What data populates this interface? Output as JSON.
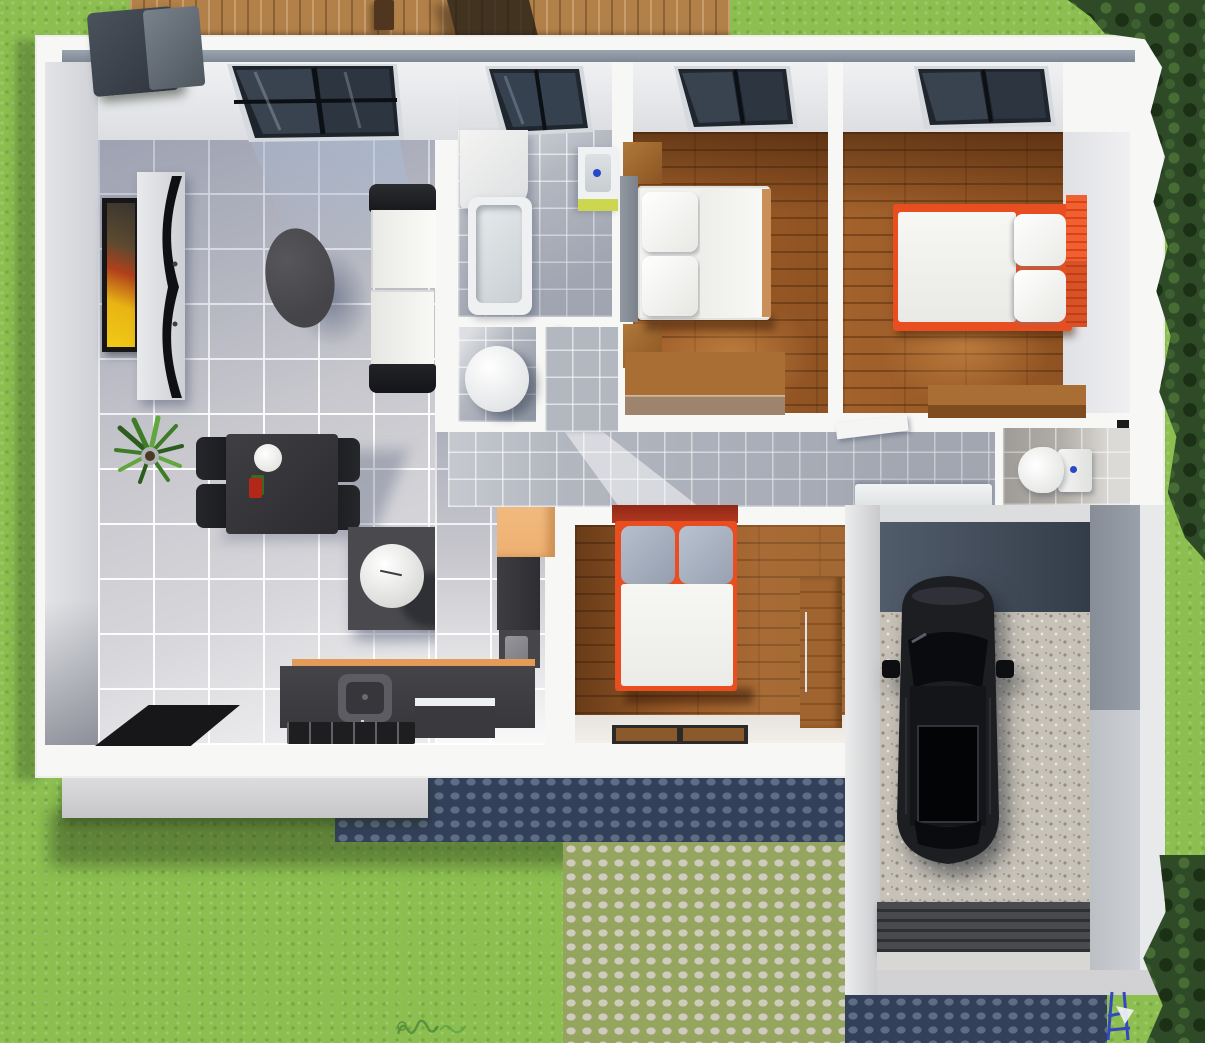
{
  "meta": {
    "content_type": "3d-floor-plan-render",
    "view": "top-down isometric",
    "canvas": {
      "width": 1205,
      "height": 1043
    },
    "text_visible": "none (illegible green watermark bottom-left of path)"
  },
  "palette": {
    "grass": "#8cbf50",
    "grass_dark": "#6fa83a",
    "deck_wood": "#b28049",
    "wall_white": "#f7f7f5",
    "slate_trim": "#8b97a2",
    "living_tile": "#c7c7cd",
    "bath_tile": "#b3b7c0",
    "bedroom_wood": "#9a5c28",
    "accent_orange": "#e84e20",
    "cabinet_peach": "#f5c188",
    "dark_furniture": "#3c3c40",
    "garage_concrete": "#4a5462",
    "garage_gravel": "#c7c2b8",
    "cobble_moss": "#95a45f",
    "cobble_stone": "#d0cbbf",
    "cobble_shadow": "#33405a",
    "trees": "#2e4a26",
    "car_black": "#17181b"
  },
  "outdoor": {
    "lawn": "green grass surrounds house",
    "deck": {
      "position": "top",
      "material": "wood planks",
      "objects": [
        "bbq-grill",
        "wood-post",
        "shade-square"
      ]
    },
    "trees": [
      "dense bushes along right edge top",
      "bush bottom-right corner"
    ],
    "driveway": {
      "material": "cobblestone",
      "areas": [
        "shaded band under house",
        "sunlit patio center-bottom",
        "shaded strip below garage"
      ]
    },
    "foundation_slab": "light gray slab bottom-left of house",
    "garden_tool": "blue hand-truck with white cone, below garage"
  },
  "rooms": [
    {
      "id": "living-kitchen",
      "floor": "large gray tile",
      "furniture": [
        "skylight-window",
        "wall-art",
        "tv-shelf",
        "curved-tv",
        "sofa-white-black",
        "coffee-table-oval",
        "house-plant",
        "dining-table",
        "dining-chairs x4",
        "plate",
        "kitchen-island",
        "sphere-lamp",
        "peach-cabinet",
        "dark-tall-units",
        "counter-with-sink",
        "cooktop",
        "dishwasher",
        "black-rug"
      ]
    },
    {
      "id": "bathroom",
      "floor": "small blue-gray tile",
      "furniture": [
        "skylight-window",
        "white-cabinet",
        "bathtub",
        "wall-sink-green-base"
      ]
    },
    {
      "id": "utility-closet",
      "furniture": [
        "water-heater-cylinder",
        "open-door"
      ]
    },
    {
      "id": "hallway",
      "floor": "small blue-gray tile",
      "furniture": [
        "white-bench",
        "open-door-leaf"
      ]
    },
    {
      "id": "wc",
      "floor": "warm gray tile",
      "furniture": [
        "toilet"
      ]
    },
    {
      "id": "bedroom-1",
      "floor": "wood planks",
      "furniture": [
        "window",
        "gray-headboard",
        "nightstand x2",
        "double-bed-white",
        "desk"
      ]
    },
    {
      "id": "bedroom-2",
      "floor": "wood planks",
      "furniture": [
        "window",
        "orange-bed-white-mattress",
        "orange-headboard",
        "desk"
      ]
    },
    {
      "id": "bedroom-3",
      "floor": "wood planks",
      "furniture": [
        "red-orange-bed",
        "gray-pillows x2",
        "wardrobe",
        "doormat"
      ]
    }
  ],
  "garage": {
    "floor": [
      "dark concrete apron",
      "speckled gravel",
      "ribbed dark ramp-mat"
    ],
    "vehicle": {
      "type": "car",
      "color": "black",
      "orientation": "vertical, nose up",
      "features": [
        "windshield",
        "sunroof",
        "rear-window",
        "side-mirrors"
      ]
    }
  }
}
